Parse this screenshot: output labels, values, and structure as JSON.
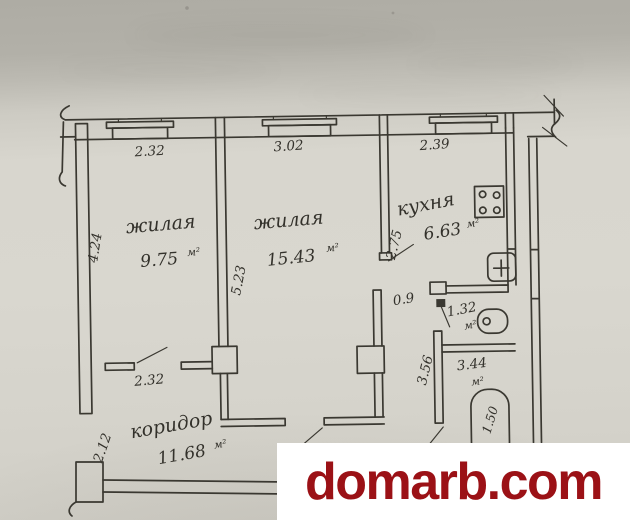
{
  "watermark": {
    "text": "domarb.com"
  },
  "colors": {
    "ink": "#3a3831",
    "paper": "#d8d6ce",
    "watermark_red": "#9b1116",
    "watermark_bg": "#ffffff"
  },
  "plan": {
    "rooms": {
      "living1": {
        "name": "жилая",
        "area": "9.75",
        "unit": "м²"
      },
      "living2": {
        "name": "жилая",
        "area": "15.43",
        "unit": "м²"
      },
      "kitchen": {
        "name": "кухня",
        "area": "6.63",
        "unit": "м²"
      },
      "wc": {
        "area": "1.32",
        "unit": "м²"
      },
      "bath": {
        "area": "3.44",
        "unit": "м²"
      },
      "corridor": {
        "name": "коридор",
        "area": "11.68",
        "unit": "м²"
      }
    },
    "dims": {
      "window1": "2.32",
      "window2": "3.02",
      "window3": "2.39",
      "room1_depth": "4.24",
      "room2_depth": "5.23",
      "kitchen_depth": "2.75",
      "kitchen_door": "0.9",
      "room1_door": "2.32",
      "corridor_depth": "2.12",
      "bath_depth": "3.56",
      "tub_length": "1.50"
    }
  }
}
